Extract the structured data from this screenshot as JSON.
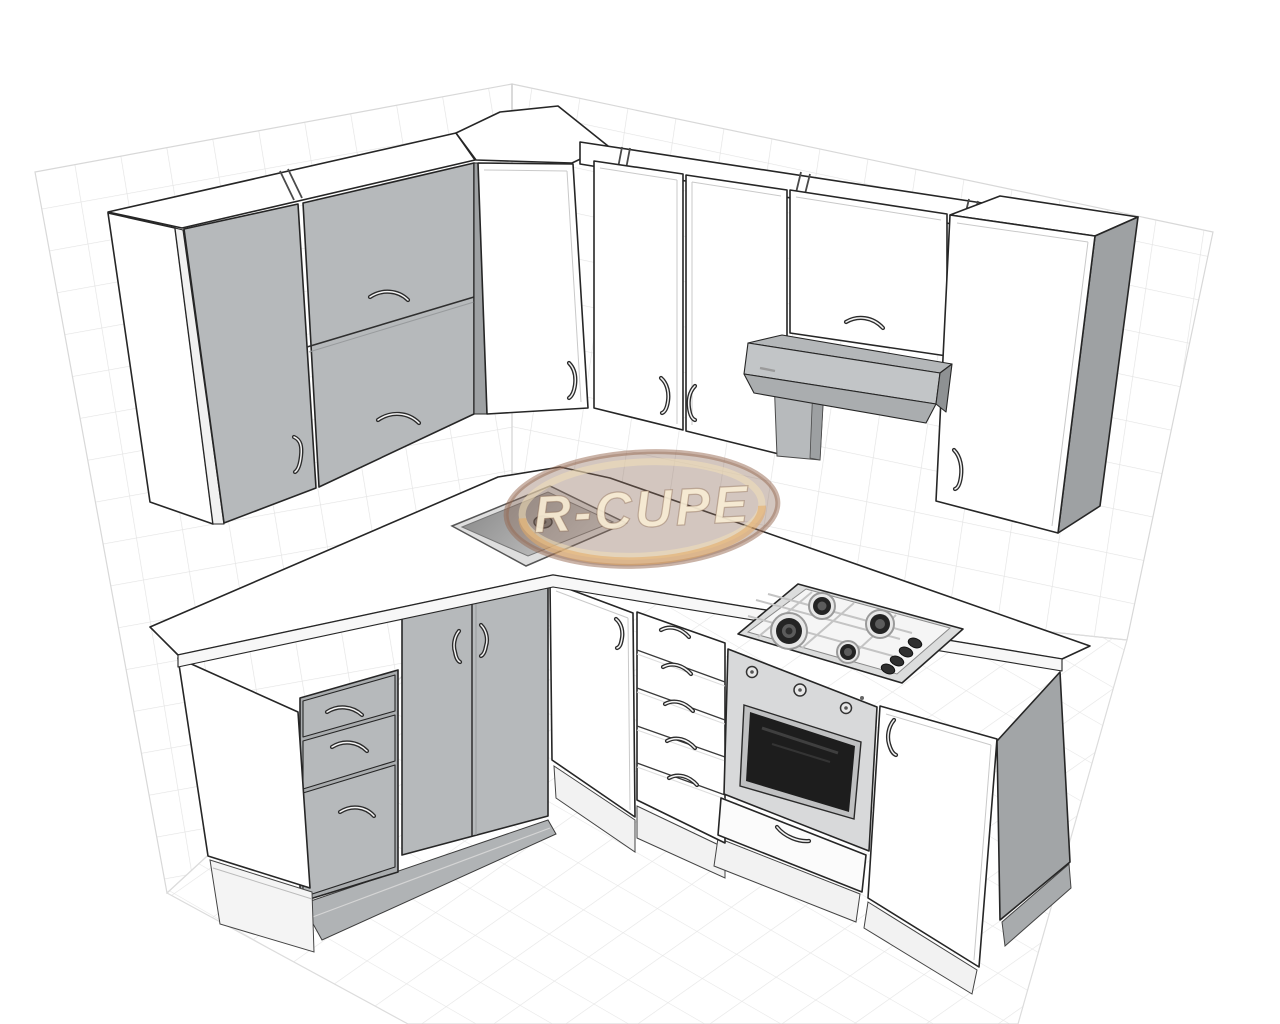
{
  "scene": {
    "title": "3D kitchen layout render",
    "view": "corner perspective of L-shaped kitchen on gridded wall and floor planes",
    "watermark": {
      "text": "R-CUPE",
      "ellipse_fill": "#92705E",
      "ring_color": "#F3E0B8",
      "accent_gold": "#E4AA64",
      "text_color": "#F7ECD4"
    },
    "palette": {
      "background": "#ffffff",
      "grid_line": "#e4e4e4",
      "outline": "#262626",
      "cabinet_white": "#ffffff",
      "cabinet_gray": "#b6b9bb",
      "side_panel_gray": "#9ea1a3",
      "hood_gray": "#c2c5c7",
      "oven_steel": "#d8d9da",
      "oven_glass": "#1d1d1d",
      "plinth_gray": "#b0b3b5",
      "sink_basin": "#8a8a8a"
    },
    "objects": [
      "wall-end-panel-white-left",
      "wall-cabinet-single-door-gray",
      "wall-cabinet-two-flip-doors-gray",
      "corner-wall-cabinet-white",
      "wall-cabinet-white-1",
      "wall-cabinet-white-2",
      "bridge-cabinet-over-hood",
      "cooker-hood",
      "tall-wall-cabinet-white-right",
      "base-end-panel-white",
      "base-drawer-unit-3-gray",
      "base-cabinet-two-doors-gray",
      "sink-base-cabinet-white",
      "base-drawer-unit-5-white",
      "built-in-oven",
      "gas-hob-4-burner",
      "base-cabinet-white-right",
      "inset-sink",
      "countertop-l-shaped",
      "wall-grid-left",
      "wall-grid-right",
      "floor-grid"
    ]
  }
}
